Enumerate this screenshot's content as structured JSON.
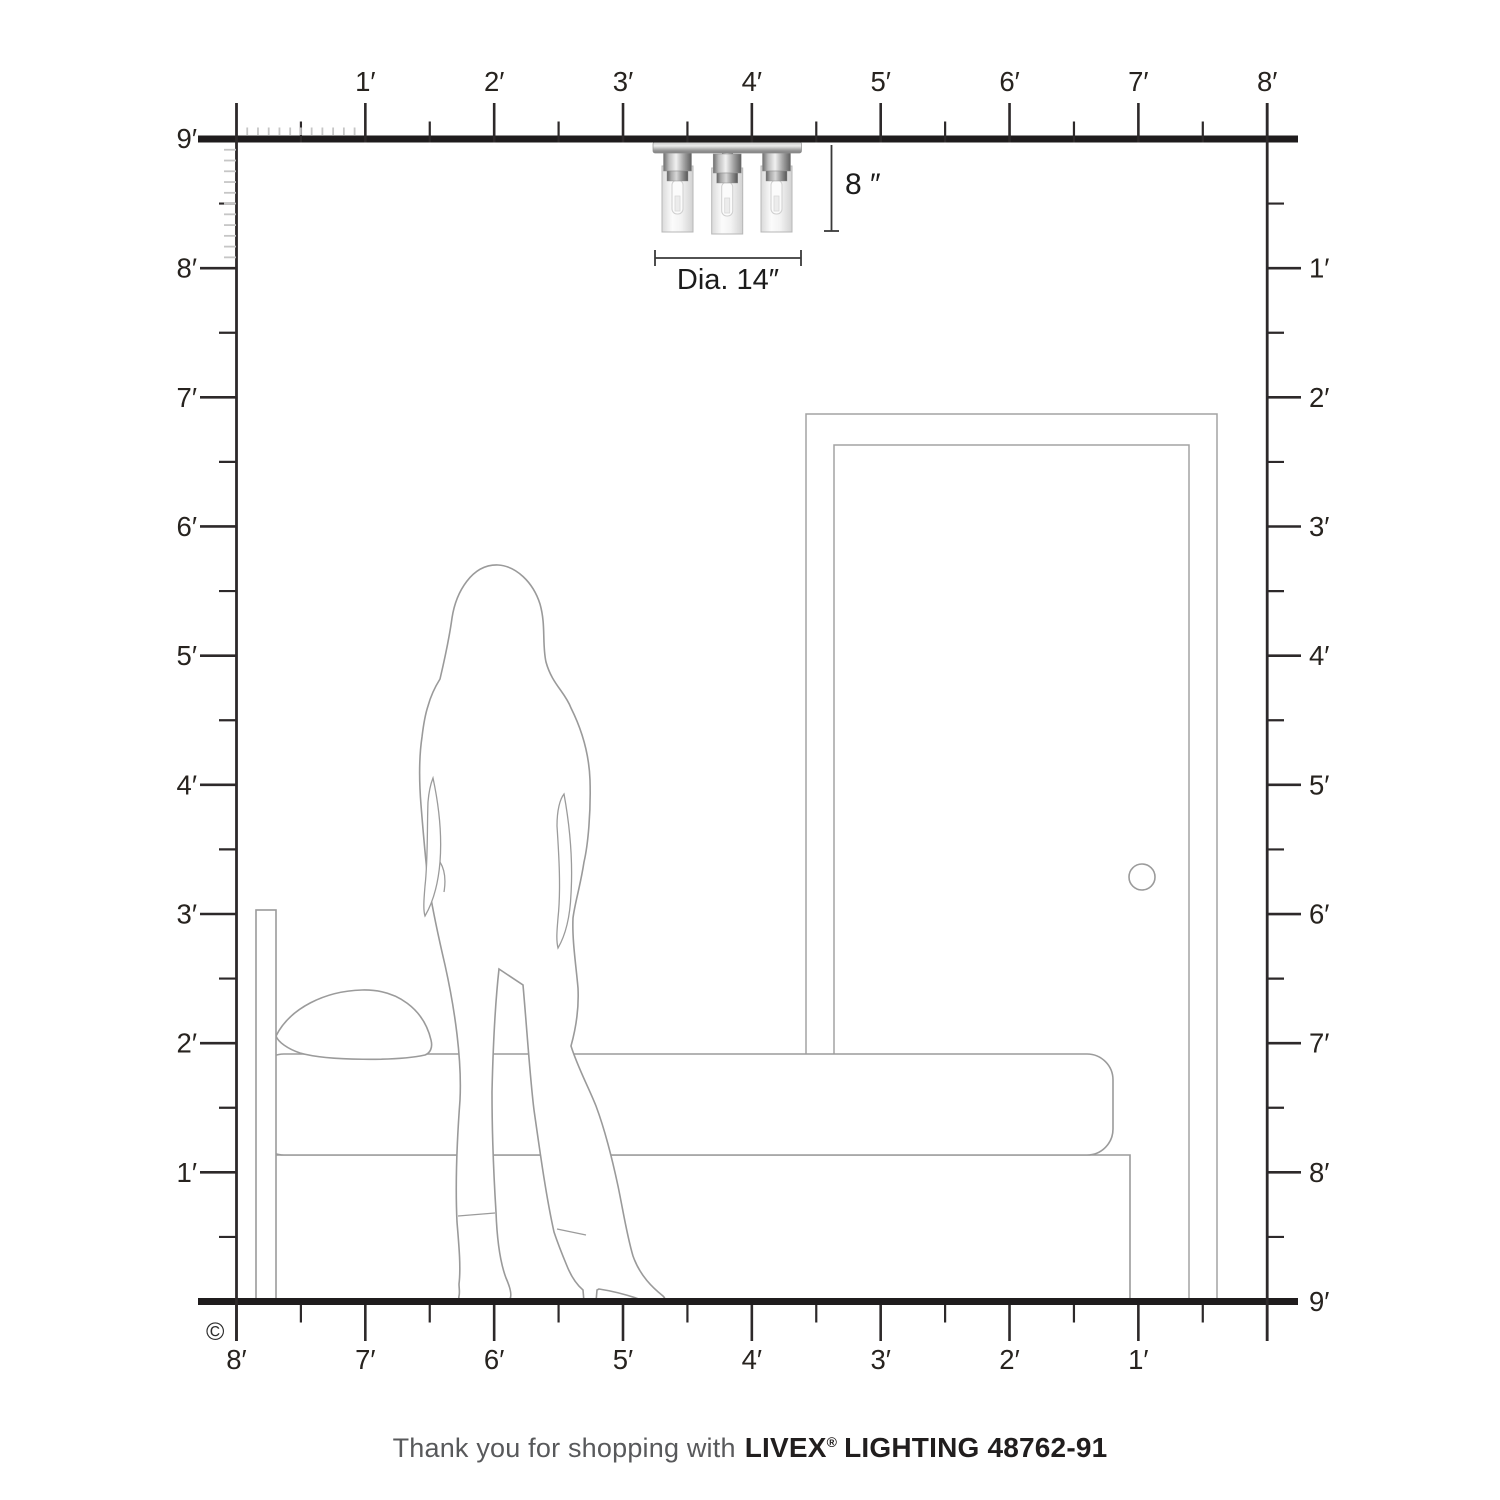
{
  "dimensions": {
    "height": "8 ″",
    "diameter": "Dia. 14″"
  },
  "rulers": {
    "top": {
      "labels": [
        "1′",
        "2′",
        "3′",
        "4′",
        "5′",
        "6′",
        "7′",
        "8′"
      ]
    },
    "left": {
      "ceiling_label": "9′",
      "labels": [
        "8′",
        "7′",
        "6′",
        "5′",
        "4′",
        "3′",
        "2′",
        "1′"
      ]
    },
    "right": {
      "labels": [
        "1′",
        "2′",
        "3′",
        "4′",
        "5′",
        "6′",
        "7′",
        "8′"
      ],
      "floor_label": "9′"
    },
    "bottom": {
      "labels": [
        "8′",
        "7′",
        "6′",
        "5′",
        "4′",
        "3′",
        "2′",
        "1′"
      ]
    }
  },
  "copyright": "©",
  "footer": {
    "prefix": "Thank you for shopping with",
    "brand": "LIVEX",
    "registered": "®",
    "product": "LIGHTING 48762-91"
  }
}
